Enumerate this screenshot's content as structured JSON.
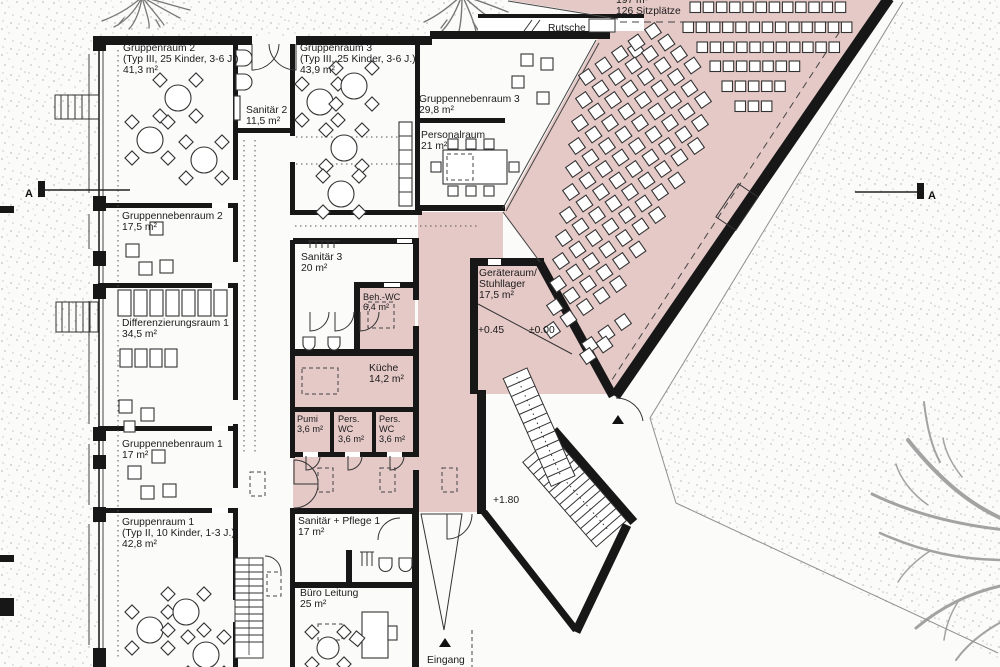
{
  "plan": {
    "section": {
      "left": "A",
      "right": "A"
    },
    "rooms": [
      {
        "id": "gruppenraum-2",
        "lines": [
          "Gruppenraum 2",
          "(Typ III, 25 Kinder, 3-6 J.)",
          "41,3 m²"
        ],
        "x": 123,
        "y": 51
      },
      {
        "id": "sanitaer-2",
        "lines": [
          "Sanitär 2",
          "11,5 m²"
        ],
        "x": 246,
        "y": 113
      },
      {
        "id": "gruppenraum-3",
        "lines": [
          "Gruppenraum 3",
          "(Typ III, 25 Kinder, 3-6 J.)",
          "43,9 m²"
        ],
        "x": 300,
        "y": 51
      },
      {
        "id": "gruppennebenraum-3",
        "lines": [
          "Gruppennebenraum 3",
          "29,8 m²"
        ],
        "x": 419,
        "y": 102
      },
      {
        "id": "personalraum",
        "lines": [
          "Personalraum",
          "21 m²"
        ],
        "x": 421,
        "y": 138
      },
      {
        "id": "gruppennebenraum-2",
        "lines": [
          "Gruppennebenraum 2",
          "17,5 m²"
        ],
        "x": 122,
        "y": 219
      },
      {
        "id": "sanitaer-3",
        "lines": [
          "Sanitär 3",
          "20 m²"
        ],
        "x": 301,
        "y": 260
      },
      {
        "id": "beh-wc",
        "lines": [
          "Beh.-WC",
          "6,4 m²"
        ],
        "x": 363,
        "y": 300,
        "small": true
      },
      {
        "id": "differenzierungsraum-1",
        "lines": [
          "Differenzierungsraum 1",
          "34,5 m²"
        ],
        "x": 122,
        "y": 326
      },
      {
        "id": "geraeteraum-stuhllager",
        "lines": [
          "Geräteraum/",
          "Stuhllager",
          "17,5 m²"
        ],
        "x": 479,
        "y": 276
      },
      {
        "id": "kueche",
        "lines": [
          "Küche",
          "14,2 m²"
        ],
        "x": 369,
        "y": 371
      },
      {
        "id": "pumi",
        "lines": [
          "Pumi",
          "3,6 m²"
        ],
        "x": 297,
        "y": 422,
        "small": true
      },
      {
        "id": "pers-wc-1",
        "lines": [
          "Pers.",
          "WC",
          "3,6 m²"
        ],
        "x": 338,
        "y": 422,
        "small": true
      },
      {
        "id": "pers-wc-2",
        "lines": [
          "Pers.",
          "WC",
          "3,6 m²"
        ],
        "x": 379,
        "y": 422,
        "small": true
      },
      {
        "id": "gruppennebenraum-1",
        "lines": [
          "Gruppennebenraum 1",
          "17 m²"
        ],
        "x": 122,
        "y": 447
      },
      {
        "id": "gruppenraum-1",
        "lines": [
          "Gruppenraum 1",
          "(Typ II, 10 Kinder, 1-3 J.)",
          "42,8 m²"
        ],
        "x": 122,
        "y": 525
      },
      {
        "id": "sanitaer-pflege-1",
        "lines": [
          "Sanitär + Pflege 1",
          "17 m²"
        ],
        "x": 298,
        "y": 524
      },
      {
        "id": "buero-leitung",
        "lines": [
          "Büro Leitung",
          "25 m²"
        ],
        "x": 300,
        "y": 596
      },
      {
        "id": "saal",
        "lines": [
          "197 m²",
          "126 Sitzplätze"
        ],
        "x": 616,
        "y": 3
      }
    ],
    "annotations": [
      {
        "id": "rutsche",
        "text": "Rutsche",
        "x": 548,
        "y": 31
      },
      {
        "id": "level-plus-045",
        "text": "+0.45",
        "x": 478,
        "y": 333
      },
      {
        "id": "level-zero",
        "text": "±0.00",
        "x": 529,
        "y": 333
      },
      {
        "id": "level-plus-180",
        "text": "+1.80",
        "x": 493,
        "y": 503
      },
      {
        "id": "eingang",
        "text": "Eingang",
        "x": 427,
        "y": 663
      }
    ],
    "colors": {
      "room_fill": "#e5c9c7",
      "wall": "#171717",
      "paper": "#fbfbfa",
      "stipple": "#bdbdbd",
      "tree": "#a3a3a3"
    }
  }
}
